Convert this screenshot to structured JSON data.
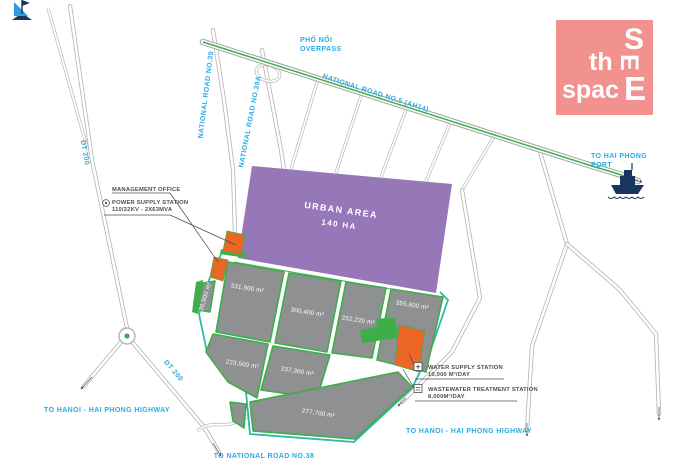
{
  "colors": {
    "accent_blue": "#29ABE2",
    "road_green": "#3DAE49",
    "teal_border": "#2CB9A9",
    "urban_purple": "#9678B8",
    "parcel_gray": "#8F9091",
    "utility_orange": "#EC6726",
    "logo_pink": "#F2928E",
    "ship_navy": "#16355F",
    "label_dark": "#4D4D4D"
  },
  "logo": {
    "s": "S",
    "th": "th",
    "e_mid": "E",
    "spac": "spac",
    "e_end": "E"
  },
  "road_labels": {
    "pho_noi_overpass": {
      "line1": "PHỐ NỐI",
      "line2": "OVERPASS"
    },
    "national_road_5": "NATIONAL ROAD NO.5 (AH14)",
    "national_road_39": "NATIONAL ROAD NO.39",
    "national_road_39a": "NATIONAL ROAD NO.39A",
    "dt200_north": "DT 200",
    "dt200_south": "DT 200"
  },
  "destinations": {
    "hai_phong_port": {
      "line1": "TO HAI PHONG",
      "line2": "PORT"
    },
    "hanoi_highway_west": "TO HANOI - HAI PHONG HIGHWAY",
    "hanoi_highway_east": "TO HANOI - HAI PHONG HIGHWAY",
    "national_road_38": "TO NATIONAL ROAD NO.38"
  },
  "urban_area": {
    "title": "URBAN AREA",
    "size": "140 HA"
  },
  "parcels": [
    {
      "area": "331,900 m²"
    },
    {
      "area": "300,400 m²"
    },
    {
      "area": "252,220 m²"
    },
    {
      "area": "355,800 m²"
    },
    {
      "area": "223,500 m²"
    },
    {
      "area": "237,300 m²"
    },
    {
      "area": "277,700 m²"
    },
    {
      "area": "30,900 m²"
    }
  ],
  "facilities": {
    "management_office": "MANAGEMENT OFFICE",
    "power_station": {
      "line1": "POWER SUPPLY STATION",
      "line2": "110/22KV - 2X63MVA"
    },
    "water_station": {
      "line1": "WATER SUPPLY STATION",
      "line2": "10,000 M³/DAY"
    },
    "wastewater_station": {
      "line1": "WASTEWATER TREATMENT STATION",
      "line2": "8,000M³/DAY"
    }
  }
}
